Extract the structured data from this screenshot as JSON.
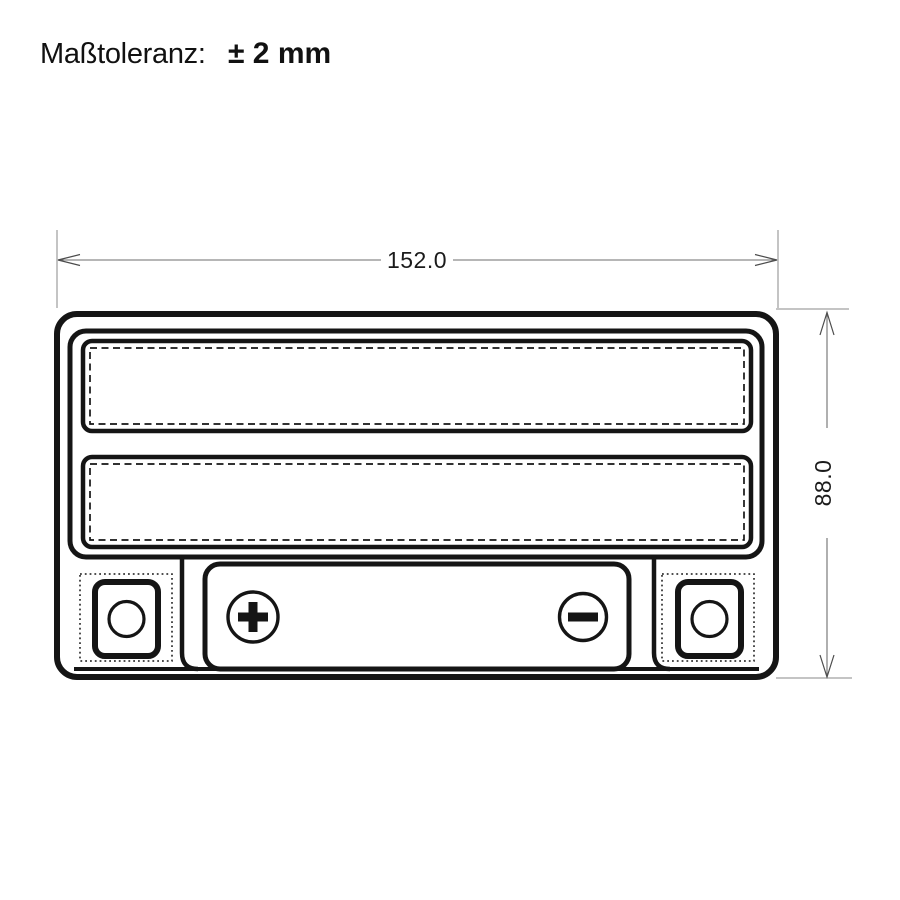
{
  "colors": {
    "background": "#ffffff",
    "drawing_line": "#151515",
    "dimension_line": "#6e6e6e",
    "text": "#111111"
  },
  "header": {
    "label": "Maßtoleranz:",
    "value": "± 2 mm"
  },
  "drawing": {
    "width_label": "152.0",
    "height_label": "88.0",
    "positive_symbol": "+",
    "negative_symbol": "−"
  }
}
